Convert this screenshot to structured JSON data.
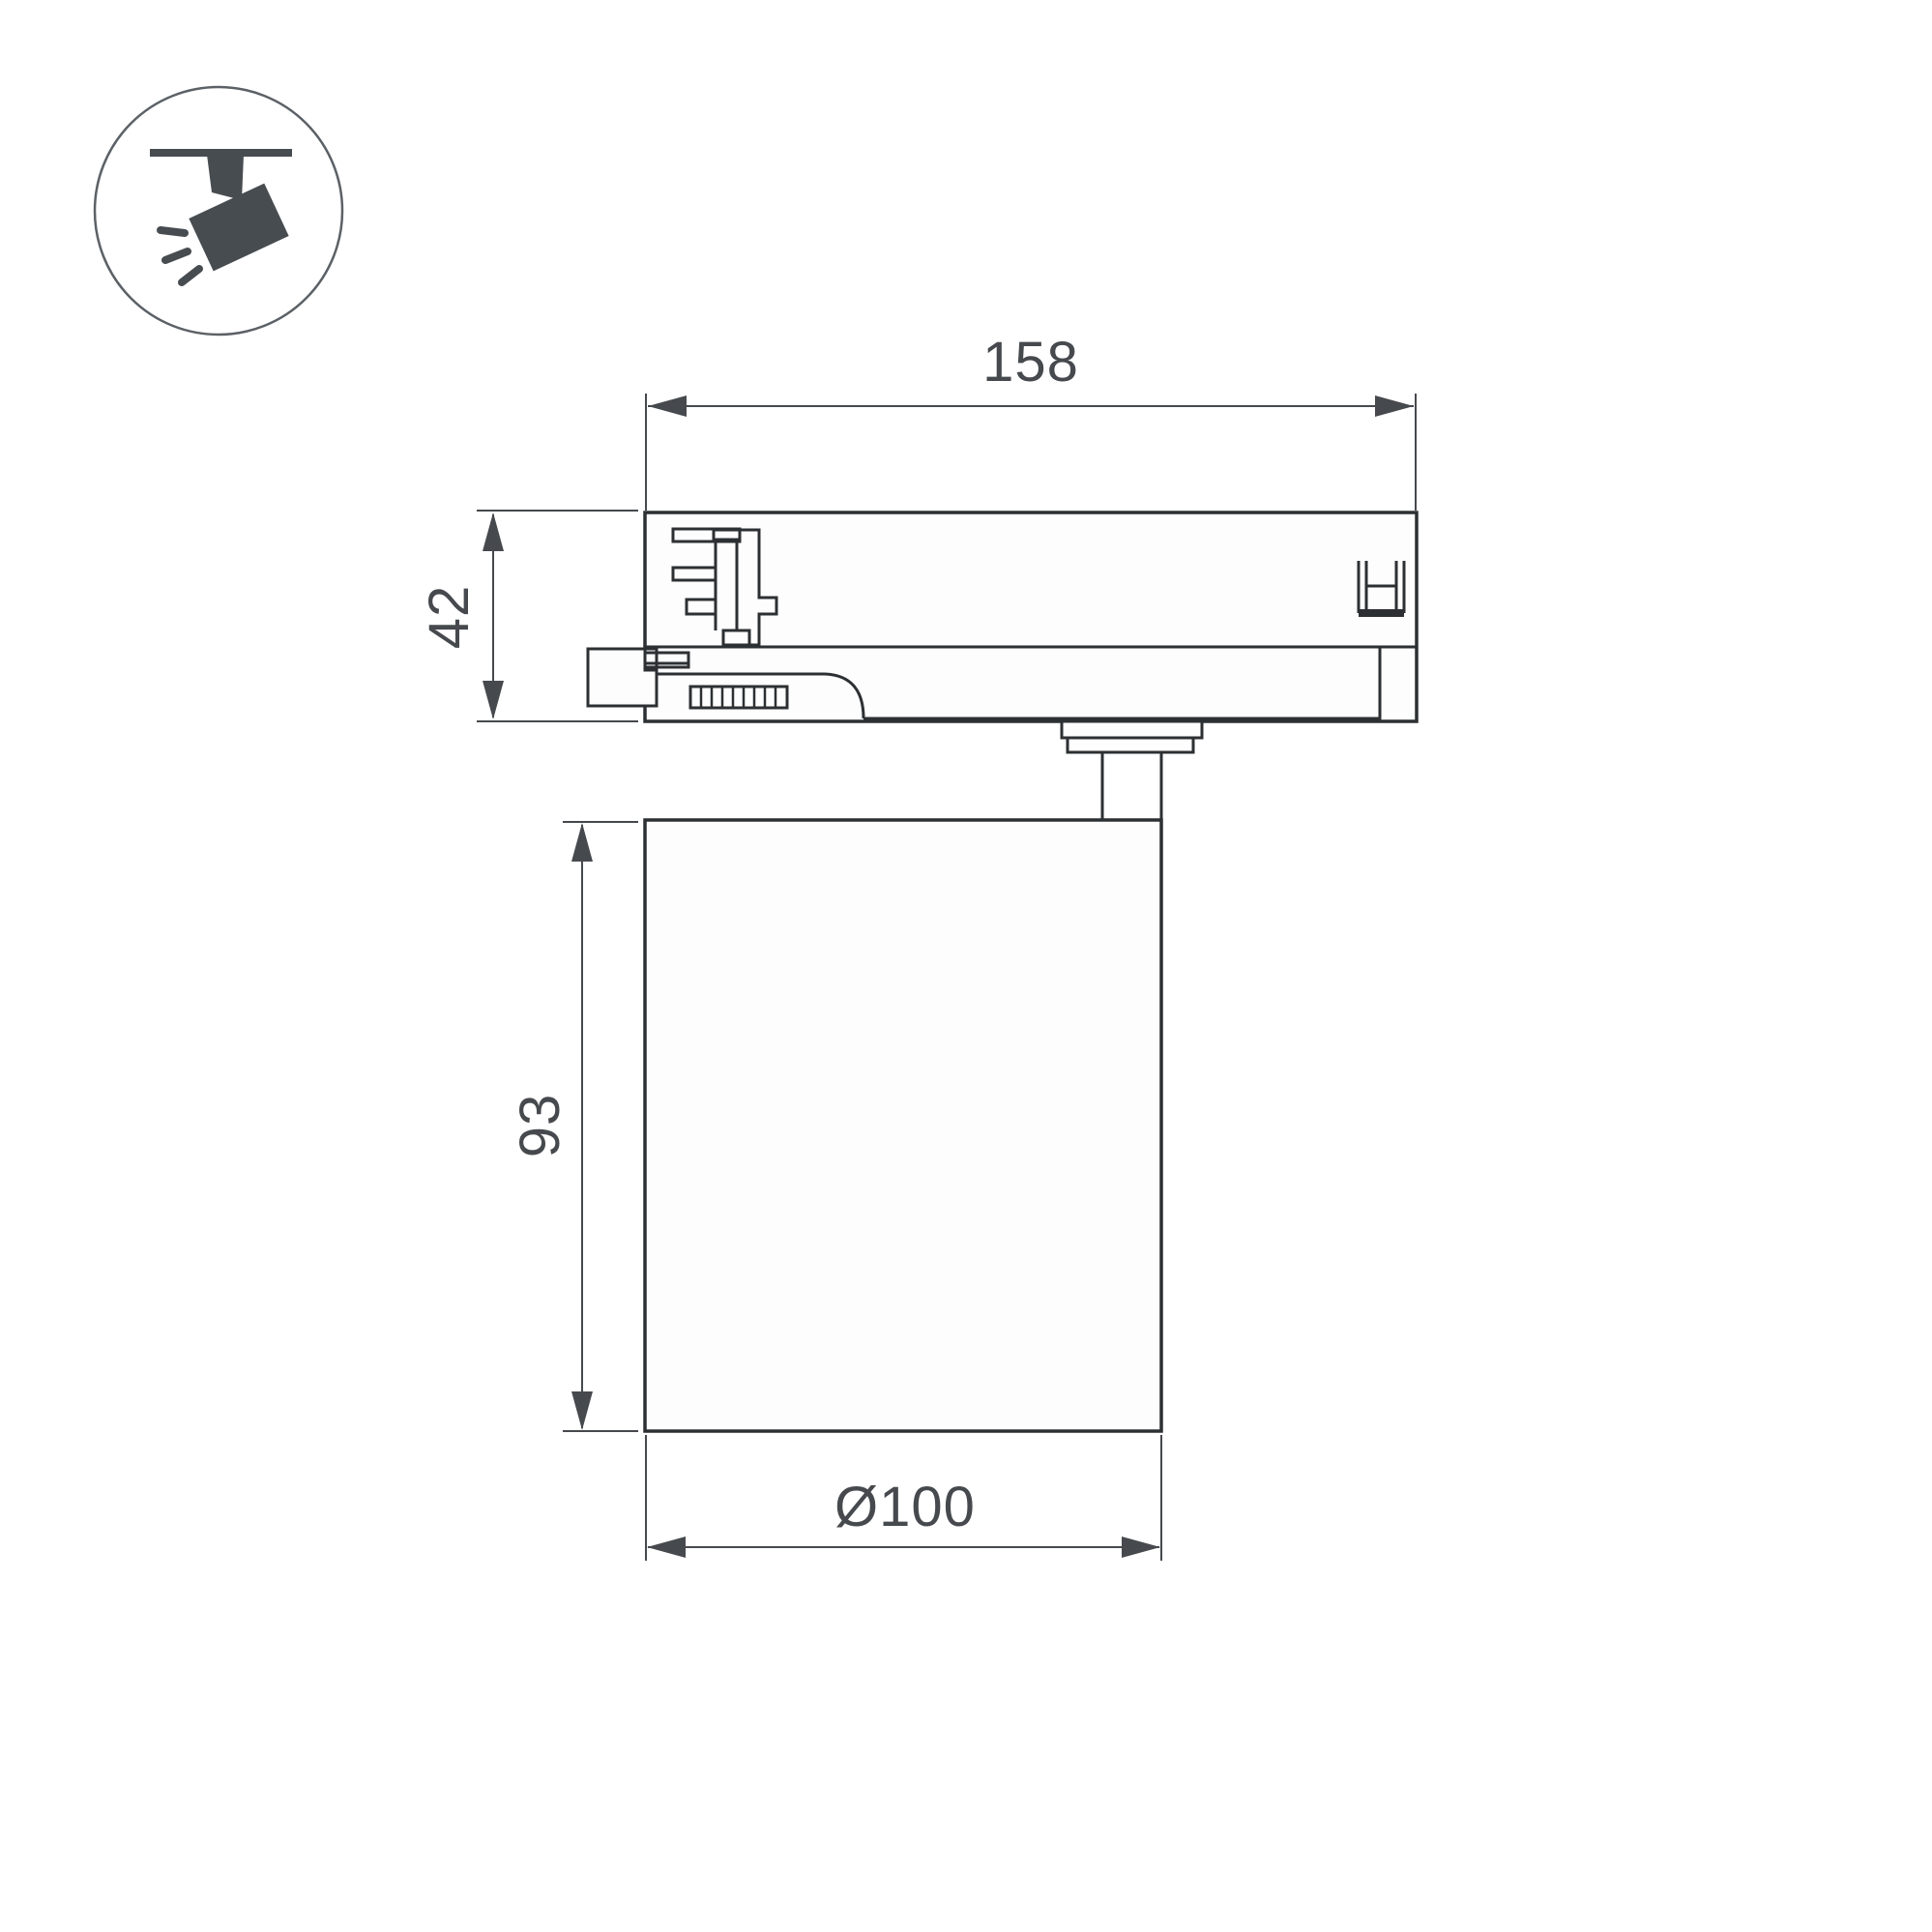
{
  "colors": {
    "outline": "#2d3033",
    "dimension": "#46494d",
    "part_fill": "#fdfdfd",
    "icon": "#474c51",
    "icon_circle": "#5b6166",
    "background": "#ffffff"
  },
  "icon": {
    "name": "track-spotlight-icon",
    "description": "ceiling track with tilted spotlight emitting rays"
  },
  "dimensions": {
    "track_adapter_width": "158",
    "track_adapter_height": "42",
    "body_height": "93",
    "body_diameter": "Ø100"
  }
}
